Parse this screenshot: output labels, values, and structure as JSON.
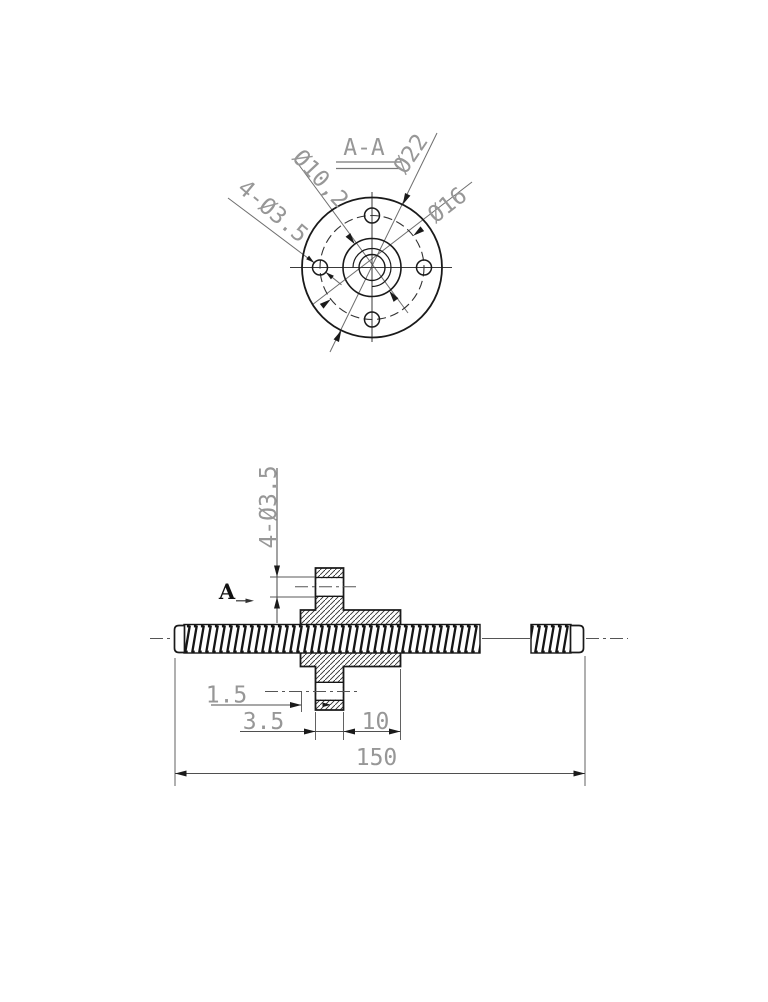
{
  "drawing": {
    "top_view": {
      "section_title": "A-A",
      "dim_bolt_holes": "4-Ø3.5",
      "dim_pilot_bore": "Ø10,2",
      "dim_flange_od": "Ø22",
      "dim_bolt_circle": "Ø16"
    },
    "side_view": {
      "section_arrow_label": "A",
      "dim_bolt_holes": "4-Ø3.5",
      "dim_boss_lip": "1.5",
      "dim_flange_thickness": "3.5",
      "dim_body_length": "10",
      "dim_overall_length": "150"
    },
    "colors": {
      "background": "#ffffff",
      "outline": "#1a1a1a",
      "dim_line": "#4f4f4f",
      "dim_text": "#979797",
      "centerline": "#555555"
    }
  }
}
